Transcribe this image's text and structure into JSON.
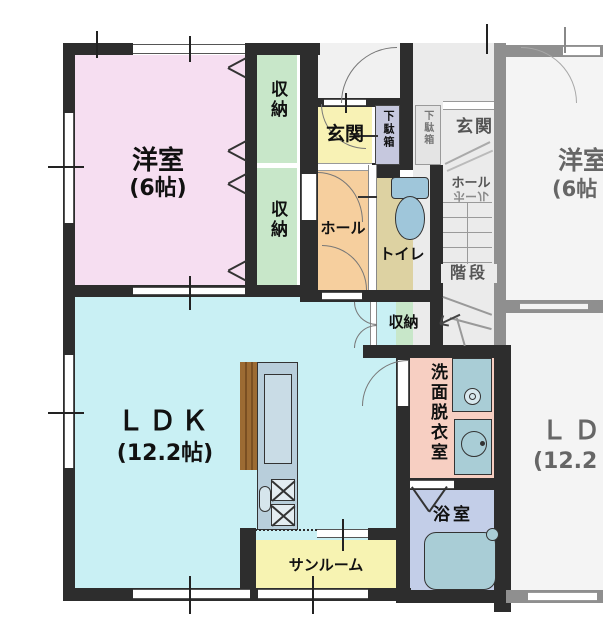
{
  "colors": {
    "wall": "#2d2d2d",
    "wall_neighbor": "#8f8f8f",
    "western_room": "#f6def1",
    "closet": "#c8e7c9",
    "entrance": "#f8f2b5",
    "shoe_cabinet": "#c6c8de",
    "hall": "#f6cf9e",
    "toilet": "#ddd2a2",
    "ldk": "#c9f0f4",
    "washroom": "#f7cfc2",
    "bathroom": "#c3cee8",
    "sunroom": "#f7f3b2",
    "fixture": "#a9cdd6",
    "kitchen_unit": "#b8cedb",
    "counter_wood": "#9c6b33",
    "neighbor_floor": "#f4f4f4"
  },
  "floorplan": {
    "left_unit": {
      "western_room": {
        "name": "洋室",
        "size": "(6帖)"
      },
      "closet_upper": "収納",
      "closet_lower": "収納",
      "entrance": "玄関",
      "shoe_cabinet": "下駄箱",
      "hall": "ホール",
      "toilet": "トイレ",
      "closet_small": "収納",
      "washroom": "洗面脱衣室",
      "bathroom": "浴室",
      "ldk": {
        "name": "ＬＤＫ",
        "size": "(12.2帖)"
      },
      "sunroom": "サンルーム"
    },
    "right_unit": {
      "entrance": "玄関",
      "shoe_cabinet": "下駄箱",
      "hall": "ホール",
      "hall_mirrored": "ホール",
      "stairs": "階段",
      "western_room": {
        "name": "洋室",
        "size": "(6帖"
      },
      "ld": {
        "name": "ＬＤ",
        "size": "(12.2"
      }
    }
  }
}
